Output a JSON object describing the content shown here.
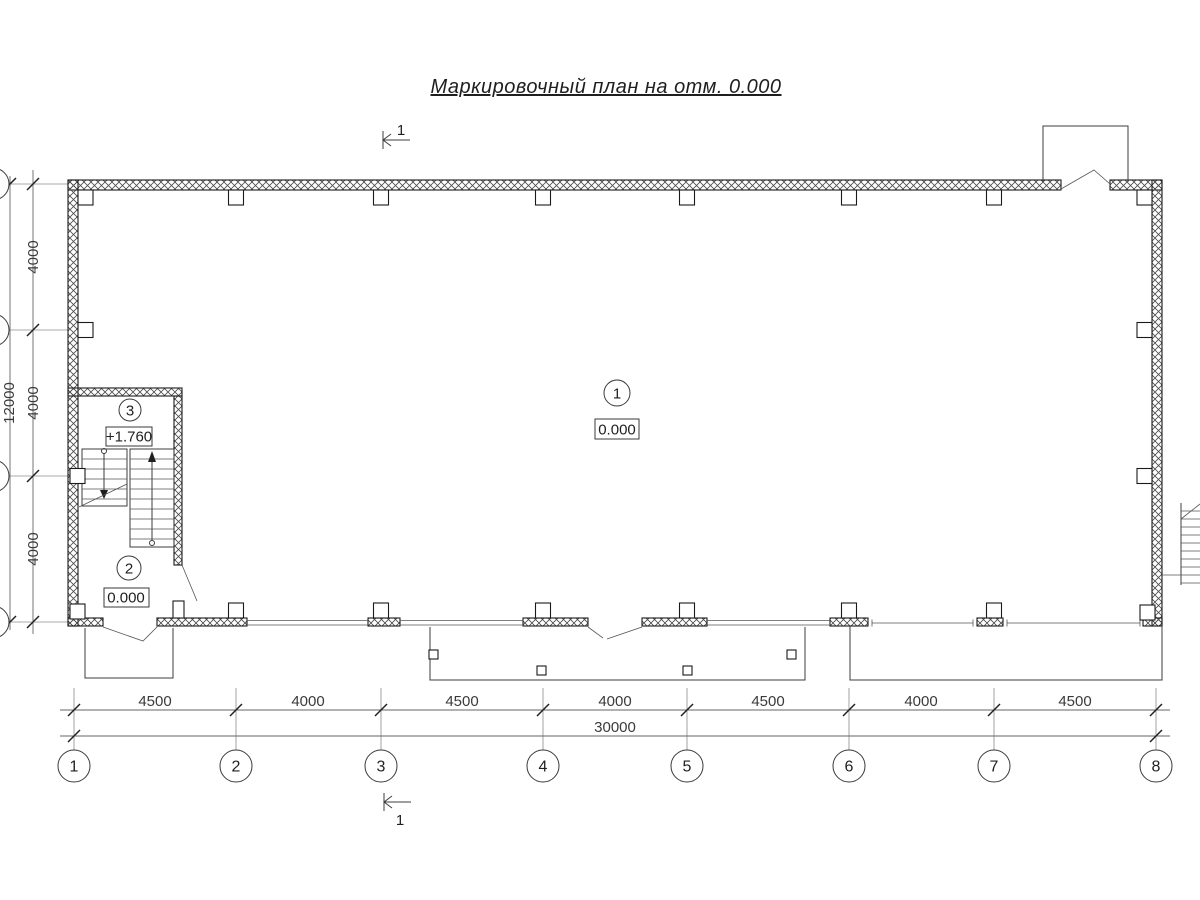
{
  "title": {
    "text": "Маркировочный план на отм. 0.000"
  },
  "section_marks": {
    "top": "1",
    "bottom": "1"
  },
  "axes": {
    "bottom": [
      "1",
      "2",
      "3",
      "4",
      "5",
      "6",
      "7",
      "8"
    ]
  },
  "dimensions": {
    "bottom_segments": [
      "4500",
      "4000",
      "4500",
      "4000",
      "4500",
      "4000",
      "4500"
    ],
    "bottom_total": "30000",
    "left_segments": [
      "4000",
      "4000",
      "4000"
    ],
    "left_total": "12000"
  },
  "rooms": [
    {
      "number": "1",
      "elevation": "0.000"
    },
    {
      "number": "2",
      "elevation": "0.000"
    },
    {
      "number": "3",
      "elevation": "+1.760"
    }
  ],
  "colors": {
    "line": "#333333",
    "wall": "#1a1a1a",
    "background": "#ffffff"
  }
}
